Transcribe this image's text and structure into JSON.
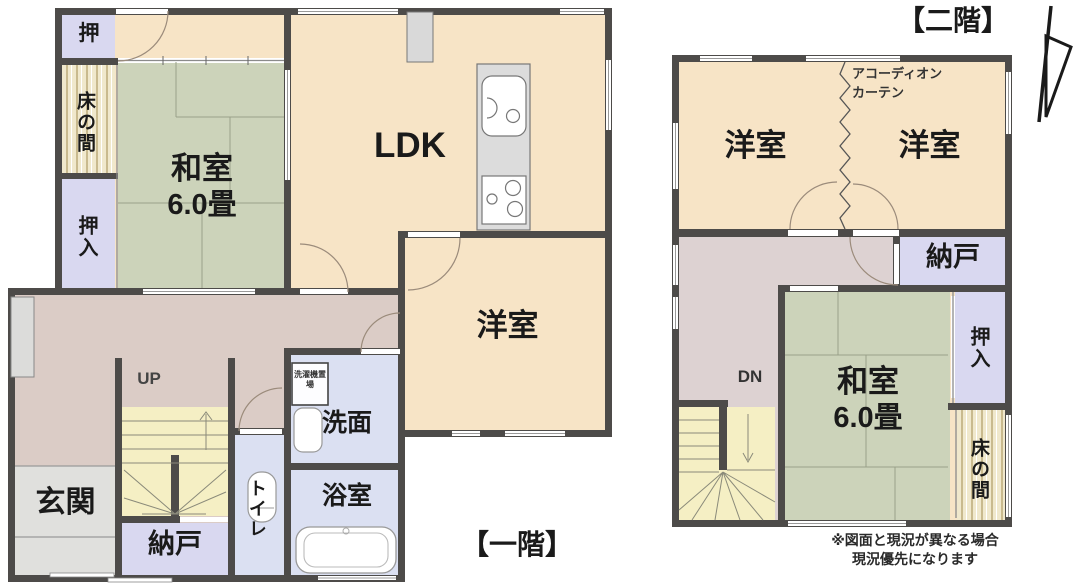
{
  "meta": {
    "drawing_type": "residential floor plan (madori-zu)",
    "disclaimer_line1": "※図面と現況が異なる場合",
    "disclaimer_line2": "現況優先になります"
  },
  "colors": {
    "wall": "#4d4b49",
    "room_cream": "#f7e4c6",
    "tatami_green": "#ccd3ba",
    "closet_lavender": "#d9d8f0",
    "wet_room_lavender": "#dbe0f2",
    "hallway_pink": "#dbccc6",
    "stairs_yellow": "#f5efc4",
    "entrance_gray": "#e0e0dd"
  },
  "first_floor": {
    "label": "【一階】",
    "washitsu": "和室",
    "washitsu_size": "6.0畳",
    "ldk": "LDK",
    "yoshitsu": "洋室",
    "genkan": "玄関",
    "nando": "納戸",
    "toilet": "トイレ",
    "senmen": "洗面",
    "yokushitsu": "浴室",
    "oshi": "押",
    "tokonoma": "床の間",
    "oshiire": "押入",
    "stairs_direction": "UP",
    "washer_note": "洗濯機置場"
  },
  "second_floor": {
    "label": "【二階】",
    "yoshitsu_left": "洋室",
    "yoshitsu_right": "洋室",
    "curtain_line1": "アコーディオン",
    "curtain_line2": "カーテン",
    "nando": "納戸",
    "oshiire": "押入",
    "washitsu": "和室",
    "washitsu_size": "6.0畳",
    "tokonoma": "床の間",
    "stairs_direction": "DN"
  }
}
